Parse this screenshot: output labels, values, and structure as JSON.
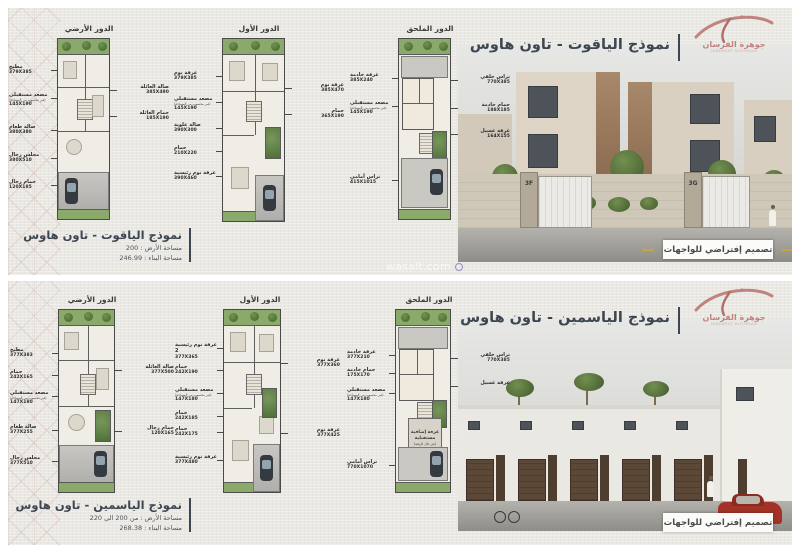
{
  "document": {
    "watermark": "wasalt.com",
    "facade_badge": "تصميم إفتراضي للواجهات",
    "logo": {
      "name": "جوهرة الفرسان",
      "subtitle": "JAWHARAT ALFURSAN"
    }
  },
  "colors": {
    "accent_rose": "#c08380",
    "title_ink": "#3d4652",
    "garden_green": "#8aa96b",
    "bronze_facade": "#96775a",
    "red_car": "#a33327"
  },
  "panels": [
    {
      "title": "نموذج الياقوت - تاون هاوس",
      "info": {
        "name": "نموذج الياقوت - تاون هاوس",
        "land": "مساحة الأرض : 200",
        "built": "مساحة البناء : 246.99"
      },
      "signs": [
        "3F",
        "3G"
      ],
      "plans": [
        {
          "name": "الدور الأرضي",
          "left": [
            {
              "t": "مطبخ",
              "d": "379X385"
            },
            {
              "t": "مصعد مستقبلي",
              "s": "(غير محسوب من المساحة)",
              "d": "145X190"
            },
            {
              "t": "صالة طعام",
              "d": "380X380"
            },
            {
              "t": "مجلس رجال",
              "d": "380X510"
            },
            {
              "t": "حمام رجال",
              "d": "120X185"
            }
          ],
          "right": [
            {
              "t": "صالة العائلة",
              "d": "385X490"
            },
            {
              "t": "حمام العائلة",
              "d": "185X190"
            }
          ]
        },
        {
          "name": "الدور الأول",
          "left": [
            {
              "t": "غرفة نوم",
              "d": "379X385"
            },
            {
              "t": "مصعد مستقبلي",
              "s": "(غير محسوب من المساحة)",
              "d": "145X190"
            },
            {
              "t": "صالة علوية",
              "d": "390X300"
            },
            {
              "t": "حمام",
              "d": "210X220"
            },
            {
              "t": "غرفة نوم رئيسية",
              "d": "390X460"
            }
          ],
          "right": [
            {
              "t": "غرفة نوم",
              "d": "385X470"
            },
            {
              "t": "حمام",
              "d": "365X190"
            }
          ]
        },
        {
          "name": "الدور الملحق",
          "left": [
            {
              "t": "غرفة خادمة",
              "d": "385X240"
            },
            {
              "t": "مصعد مستقبلي",
              "s": "(غير محسوب من المساحة)",
              "d": "145X190"
            },
            {
              "t": "تراس أمامي",
              "d": "415X1015"
            }
          ],
          "right": [
            {
              "t": "تراس خلفي",
              "d": "770X385"
            },
            {
              "t": "حمام خادمة",
              "d": "188X185"
            },
            {
              "t": "غرفة غسيل",
              "d": "164X155"
            }
          ]
        }
      ]
    },
    {
      "title": "نموذج الياسمين - تاون هاوس",
      "info": {
        "name": "نموذج الياسمين - تاون هاوس",
        "land": "مساحة الأرض : من 200 الى 220",
        "built": "مساحة البناء : 268.38"
      },
      "plans": [
        {
          "name": "الدور الأرضي",
          "left": [
            {
              "t": "مطبخ",
              "d": "377X383"
            },
            {
              "t": "حمام",
              "d": "242X165"
            },
            {
              "t": "مصعد مستقبلي",
              "s": "(غير محسوب من المساحة)",
              "d": "147X180"
            },
            {
              "t": "صالة طعام",
              "d": "377X255"
            },
            {
              "t": "مجلس رجال",
              "d": "377X510"
            }
          ],
          "right": [
            {
              "t": "صالة العائلة",
              "d": "377X500"
            },
            {
              "t": "حمام رجال",
              "d": "120X165"
            }
          ]
        },
        {
          "name": "الدور الأول",
          "left": [
            {
              "t": "غرفة نوم رئيسية 2",
              "d": "377X365"
            },
            {
              "t": "حمام",
              "d": "242X190"
            },
            {
              "t": "مصعد مستقبلي",
              "s": "(غير محسوب من المساحة)",
              "d": "147X180"
            },
            {
              "t": "حمام",
              "d": "242X185"
            },
            {
              "t": "حمام",
              "d": "242X175"
            },
            {
              "t": "غرفة نوم رئيسية",
              "d": "377X480"
            }
          ],
          "right": [
            {
              "t": "غرفة نوم",
              "d": "377X360"
            },
            {
              "t": "غرفة نوم",
              "d": "377X425"
            }
          ]
        },
        {
          "name": "الدور الملحق",
          "left": [
            {
              "t": "غرفة خادمة",
              "d": "377X210"
            },
            {
              "t": "حمام خادمة",
              "d": "175X170"
            },
            {
              "t": "مصعد مستقبلي",
              "s": "(غير محسوب من المساحة)",
              "d": "147X180"
            },
            {
              "t": "تراس أمامي",
              "d": "770X1070"
            }
          ],
          "center": {
            "t": "غرفة إضافية",
            "t2": "مستقبلية",
            "s": "(في حال الرغبة)"
          },
          "right": [
            {
              "t": "تراس خلفي",
              "d": "770X385"
            },
            {
              "t": "غرفة غسيل",
              "d": ""
            }
          ]
        }
      ]
    }
  ]
}
